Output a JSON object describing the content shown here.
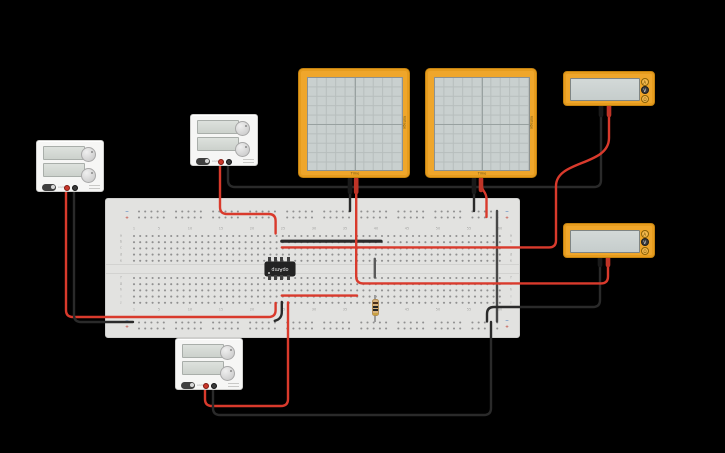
{
  "workspace": {
    "background": "#000000"
  },
  "breadboard": {
    "column_numbers": [
      "1",
      "5",
      "10",
      "15",
      "20",
      "25",
      "30",
      "35",
      "40",
      "45",
      "50",
      "55",
      "60"
    ],
    "row_letters_top": [
      "a",
      "b",
      "c",
      "d",
      "e"
    ],
    "row_letters_bottom": [
      "f",
      "g",
      "h",
      "i",
      "j"
    ],
    "rail_minus": "−",
    "rail_plus": "+"
  },
  "chip": {
    "label": "opAmp"
  },
  "oscilloscope": {
    "time_label": "Time",
    "voltage_label": "Voltage"
  },
  "multimeter": {
    "buttons": {
      "amps": "A",
      "volts": "V",
      "ohms": "Ω"
    },
    "selected_mode": "V"
  },
  "power_supply": {
    "switch_label": "on/off"
  },
  "resistor": {
    "bands": [
      "#4a2f1c",
      "#242424",
      "#242424",
      "#c9a23f"
    ]
  },
  "colors": {
    "red": "#d93a2c",
    "black": "#2a2a2a",
    "gray": "#474747",
    "gray2": "#5a5a5a",
    "stub_black": "#1a1a1a",
    "stub_red": "#bf3427",
    "board": "#e2e2e0",
    "device_orange": "#efa62b"
  },
  "wires": [
    {
      "name": "row-b-jumper-wire",
      "color": "black",
      "width": 3.2,
      "path": "M281.8,241.2 L381,241.2"
    },
    {
      "name": "row-i-wire",
      "color": "red",
      "path": "M281.8,295.6 L357,295.6"
    },
    {
      "name": "rail-bridge-wire",
      "color": "gray",
      "path": "M497,211 L497,321.5"
    },
    {
      "name": "gap-jumper-wire",
      "color": "gray2",
      "path": "M374.8,258.8 L374.8,277.5"
    },
    {
      "name": "row-j-ground-jumper",
      "color": "black",
      "path": "M281.8,302 L281.8,312 Q281.8,319 274.8,320.8"
    },
    {
      "name": "psu1-positive-wire",
      "color": "red",
      "path": "M66,189 L66,310 Q66,317 73,317 L268.6,317 Q275.6,317 275.6,310 L275.6,303"
    },
    {
      "name": "psu1-negative-wire",
      "color": "black",
      "path": "M74,189 L74,315 Q74,322 81,322 L133,322"
    },
    {
      "name": "psu2-positive-wire",
      "color": "red",
      "path": "M220,163 L220,207 Q220,214 227,214 L268.6,214 Q275.6,214 275.6,221 L275.6,233.5"
    },
    {
      "name": "psu2-negative-wire",
      "color": "black",
      "path": "M228,163 L228,180 Q228,187 235,187 L594,187 Q601,187 601,180 L601,110"
    },
    {
      "name": "psu3-positive-wire",
      "color": "red",
      "path": "M205,387 L205,399 Q205,406 212,406 L281,406 Q288,406 288,399 L288,302.5"
    },
    {
      "name": "psu3-negative-wire",
      "color": "black",
      "path": "M213,387 L213,408 Q213,415 220,415 L484,415 Q491,415 491,408 L491,322"
    },
    {
      "name": "multimeter1-red-wire",
      "color": "red",
      "path": "M281.8,247.4 L549,247.4 Q556,247.4 556,240.4 L556,186 C556,160 609,166 609,138 L609,110"
    },
    {
      "name": "multimeter2-black-wire",
      "color": "black",
      "path": "M600,264 L600,300 Q600,307 593,307 L494,307 Q487,307 487,314 L487,321.5"
    },
    {
      "name": "scope1-black-probe-wire",
      "color": "black",
      "path": "M350,184 L350,211"
    },
    {
      "name": "scope1-red-probe-wire",
      "color": "red",
      "path": "M356.2,184 L356.2,276.4 Q356.2,283.4 363.2,283.4 L601,283.4 Q608,283.4 608,276.4 L608,263"
    },
    {
      "name": "scope2-black-probe-wire",
      "color": "black",
      "path": "M474,184 L474,211"
    },
    {
      "name": "scope2-red-probe-wire",
      "color": "red",
      "path": "M481,183 C481,191 486.5,191 486.5,199 L486.5,217"
    }
  ],
  "probe_stubs": [
    {
      "name": "scope1-black-probe",
      "color": "stub_black",
      "path": "M350,179 L350,192"
    },
    {
      "name": "scope1-red-probe",
      "color": "stub_red",
      "path": "M356.2,179 L356.2,192"
    },
    {
      "name": "scope2-black-probe",
      "color": "stub_black",
      "path": "M474,179 L474,192"
    },
    {
      "name": "scope2-red-probe",
      "color": "stub_red",
      "path": "M481,179 L481,190"
    },
    {
      "name": "multimeter1-black-probe",
      "color": "stub_black",
      "path": "M601,104 L601,115"
    },
    {
      "name": "multimeter1-red-probe",
      "color": "stub_red",
      "path": "M609,104 L609,115"
    },
    {
      "name": "multimeter2-black-probe",
      "color": "stub_black",
      "path": "M600,254 L600,265"
    },
    {
      "name": "multimeter2-red-probe",
      "color": "stub_red",
      "path": "M608,254 L608,265"
    }
  ]
}
